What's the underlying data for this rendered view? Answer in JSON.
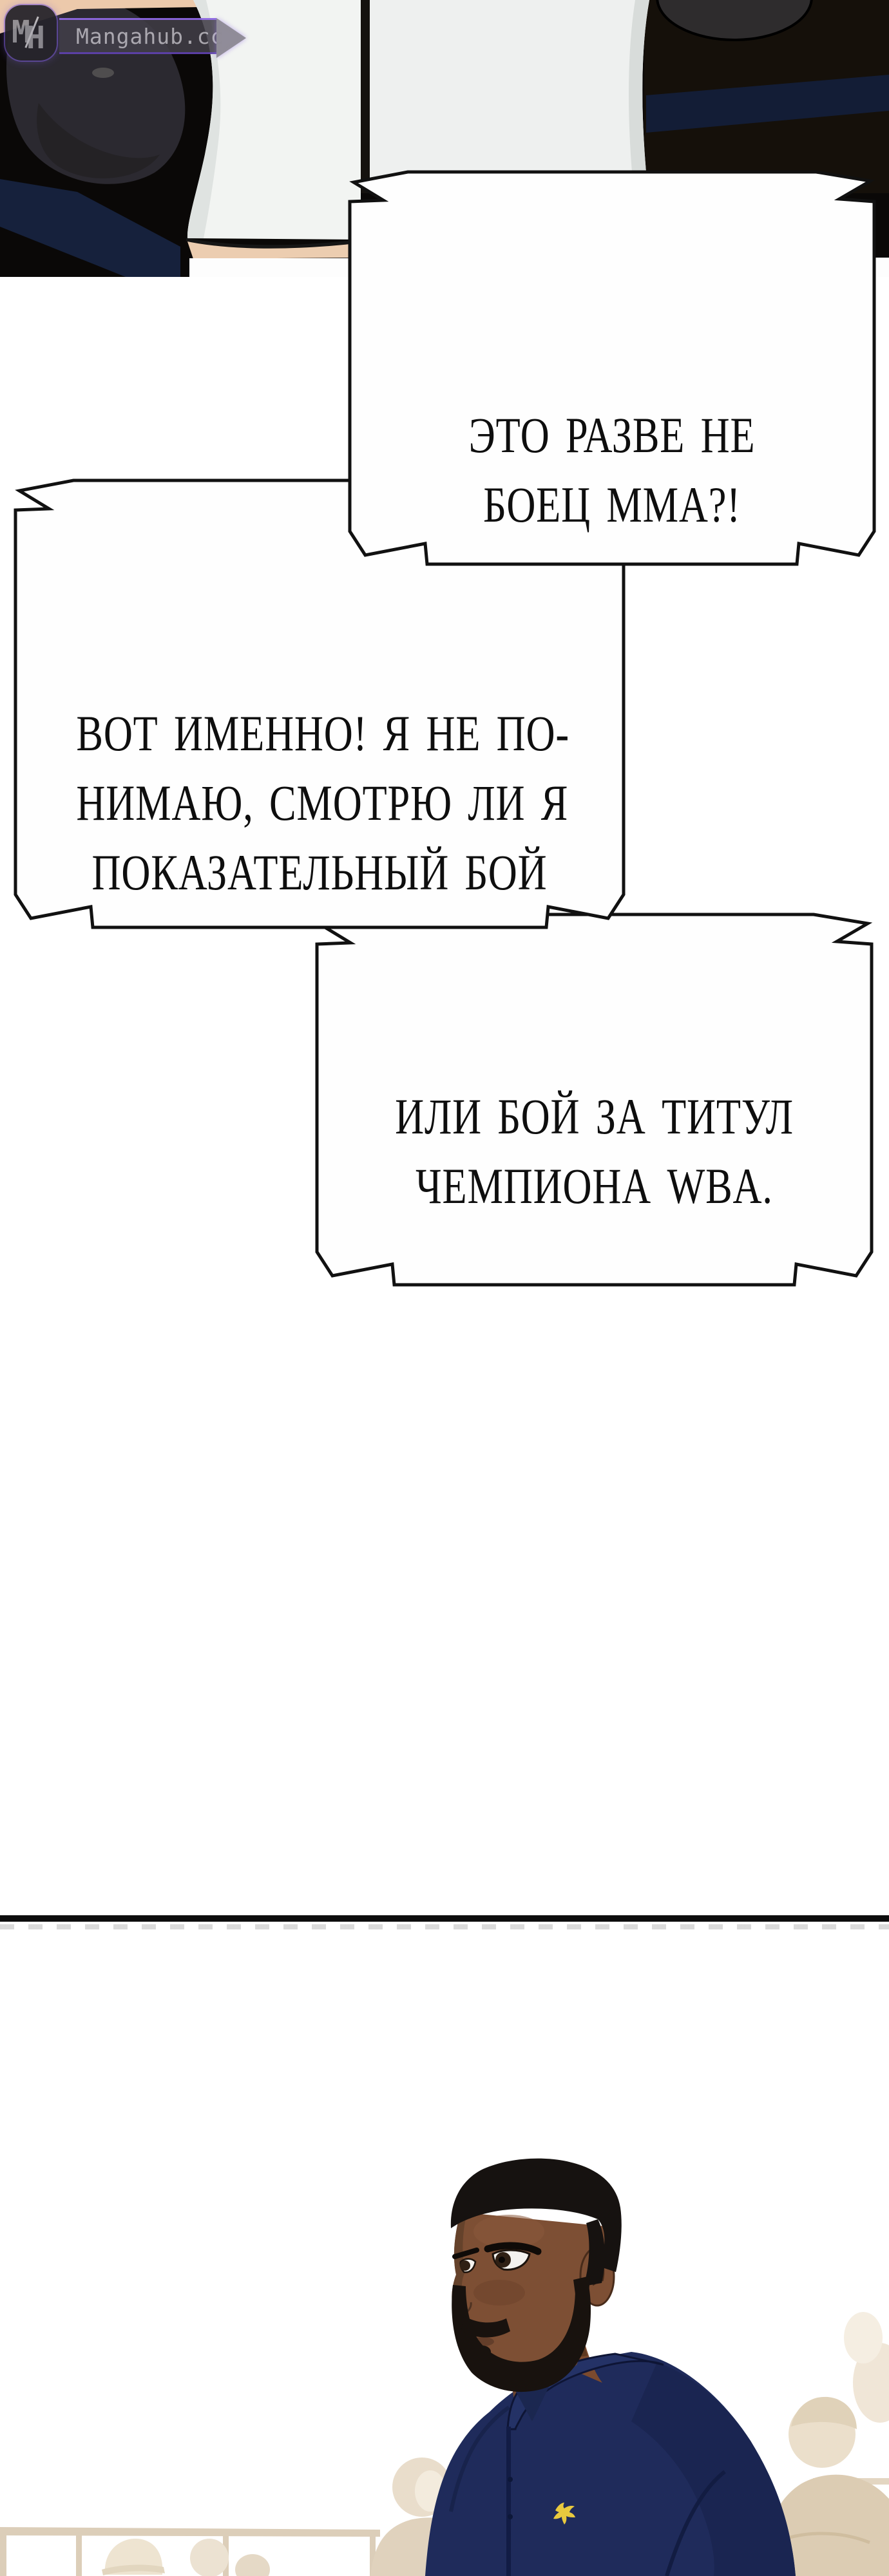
{
  "watermark": {
    "monogram_m": "M",
    "monogram_h": "H",
    "site": "Mangahub.cc"
  },
  "bubbles": {
    "b1": {
      "lines": [
        "ЭТО РАЗВЕ НЕ",
        "БОЕЦ ММА?!"
      ]
    },
    "b2": {
      "lines": [
        "ВОТ ИМЕННО! Я НЕ ПО-",
        "НИМАЮ, СМОТРЮ ЛИ Я",
        "ПОКАЗАТЕЛЬНЫЙ БОЙ"
      ]
    },
    "b3": {
      "lines": [
        "ИЛИ БОЙ ЗА ТИТУЛ",
        "ЧЕМПИОНА WBA."
      ]
    }
  },
  "colors": {
    "page_bg": "#ffffff",
    "panel_bg": "#0a0807",
    "bubble_fill": "#fefefe",
    "bubble_stroke": "#111111",
    "bubble_text": "#0e0e0e",
    "divider": "#0d0d0d",
    "divider_dash": "#bdbdbd",
    "shirt_navy": "#1f2b5b",
    "skin_brown": "#7d4f34",
    "hair_black": "#161210",
    "logo_yellow": "#e8c93e",
    "crowd_tan": "#e7dac4",
    "railing_tan": "#d9c9b2",
    "rope_navy": "#141e38",
    "pants_white": "#f2f4f2",
    "pale_skin": "#ecc9ab",
    "watermark_purple": "#7a5bd6",
    "watermark_gray": "#8f8d93"
  }
}
